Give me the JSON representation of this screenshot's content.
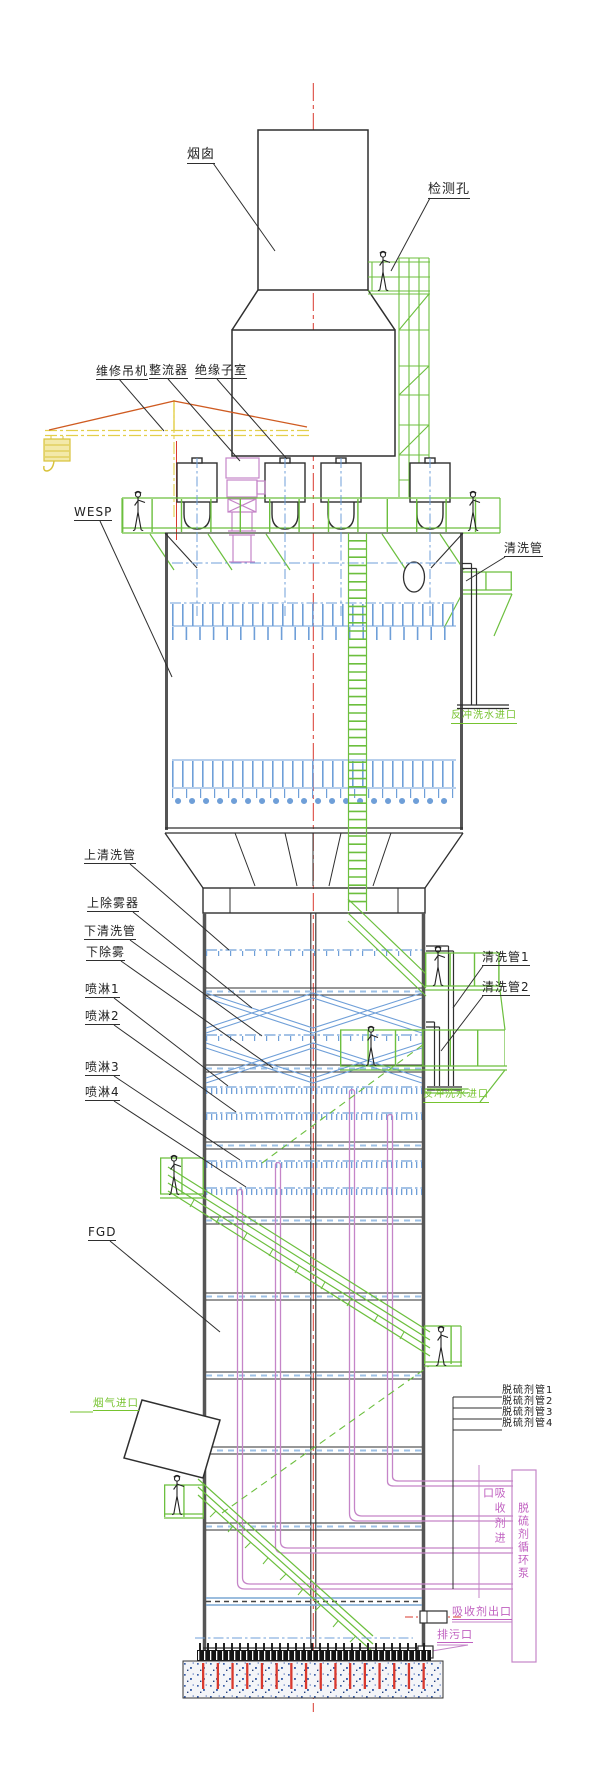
{
  "meta": {
    "width": 600,
    "height": 1782,
    "background": "#ffffff"
  },
  "colors": {
    "line": "#2f2f2f",
    "wall": "#555555",
    "blue_pipe": "#6f9fd8",
    "green_structure": "#6cbf3e",
    "green_text": "#76c32f",
    "magenta_pipe": "#c585c8",
    "magenta_text": "#c060c0",
    "red_centerline": "#d9392e",
    "yellow_crane": "#e3cf4a",
    "orange_guy": "#cf5b21"
  },
  "labels": {
    "chimney": "烟囱",
    "inspection_hole": "检测孔",
    "maintenance_crane": "维修吊机",
    "rectifier": "整流器",
    "insulator_room": "绝缘子室",
    "wesp": "WESP",
    "cleaning_pipe": "清洗管",
    "backwash_water_inlet_upper": "反冲洗水进口",
    "upper_cleaning_pipe": "上清洗管",
    "upper_demister": "上除雾器",
    "lower_cleaning_pipe": "下清洗管",
    "lower_demister": "下除雾",
    "spray_1": "喷淋1",
    "spray_2": "喷淋2",
    "spray_3": "喷淋3",
    "spray_4": "喷淋4",
    "cleaning_pipe_1": "清洗管1",
    "cleaning_pipe_2": "清洗管2",
    "backwash_water_inlet_lower": "反冲洗水进口",
    "fgd": "FGD",
    "flue_gas_inlet": "烟气进口",
    "desulfurizer_pipe_1": "脱硫剂管1",
    "desulfurizer_pipe_2": "脱硫剂管2",
    "desulfurizer_pipe_3": "脱硫剂管3",
    "desulfurizer_pipe_4": "脱硫剂管4",
    "absorbent_inlet": "吸收剂进口",
    "desulfurizer_circulation_pump": "脱硫剂循环泵",
    "absorbent_outlet": "吸收剂出口",
    "drain_outlet": "排污口"
  }
}
